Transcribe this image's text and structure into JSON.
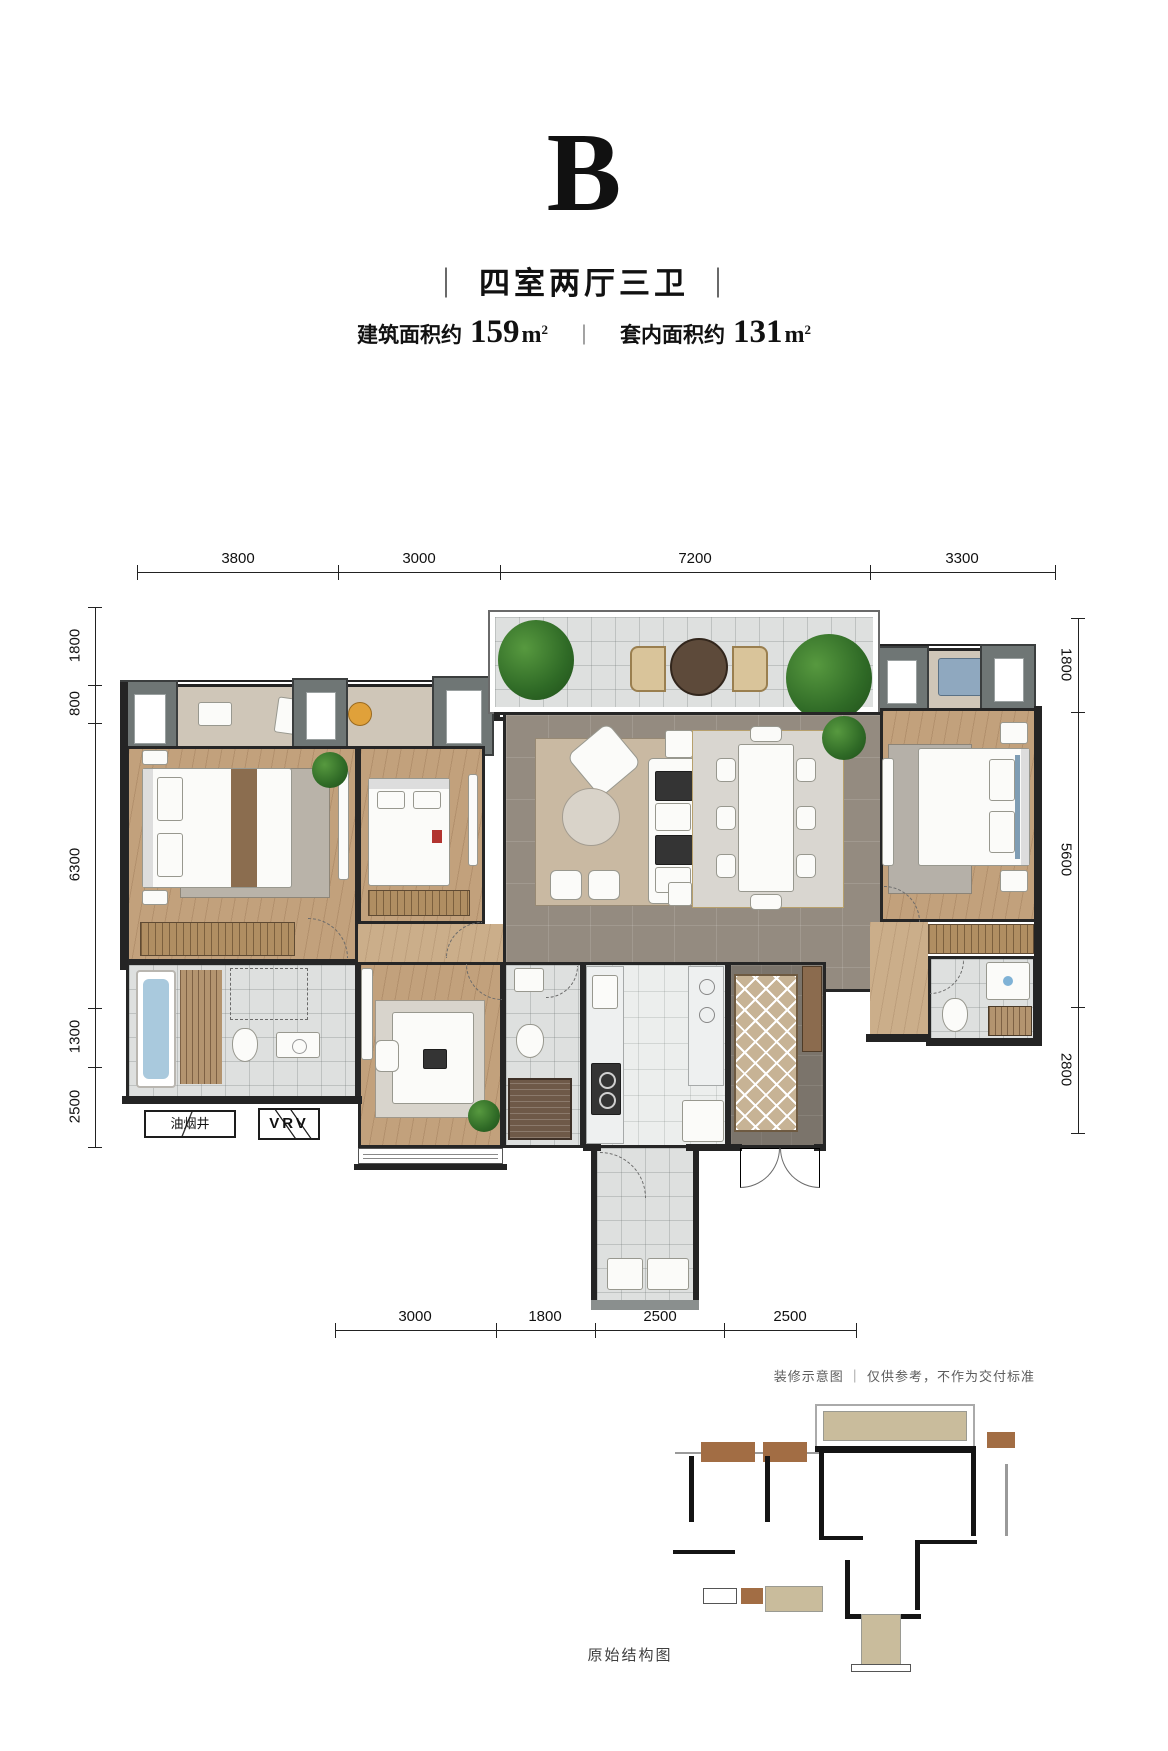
{
  "header": {
    "unit_letter": "B",
    "delimiter_bar": "｜",
    "layout_type": "四室两厅三卫",
    "gross_area_label": "建筑面积约",
    "gross_area_value": "159",
    "area_unit_base": "m",
    "area_unit_exponent": "2",
    "inner_area_label": "套内面积约",
    "inner_area_value": "131"
  },
  "dimensions": {
    "top": [
      "3800",
      "3000",
      "7200",
      "3300"
    ],
    "left": [
      "1800",
      "800",
      "6300",
      "1300",
      "2500"
    ],
    "right": [
      "1800",
      "5600",
      "2800"
    ],
    "bottom": [
      "3000",
      "1800",
      "2500",
      "2500"
    ]
  },
  "plan_annotations": {
    "smoke_shaft_label": "油烟井",
    "vrv_label": "VRV"
  },
  "footer": {
    "disclaimer": "装修示意图 ｜ 仅供参考，不作为交付标准",
    "structure_caption": "原始结构图"
  },
  "palette": {
    "wall": "#242424",
    "wood_floor": "#c2a17c",
    "living_tile": "#948b80",
    "bath_tile": "#dee0df",
    "balcony_beige": "#cfc6b8",
    "rug_tan": "#c9b9a2",
    "bathtub_blue": "#a9c9dd",
    "plant_green": "#3f7d31",
    "structure_brown": "#a26d44",
    "structure_tan": "#c9bc9c"
  }
}
